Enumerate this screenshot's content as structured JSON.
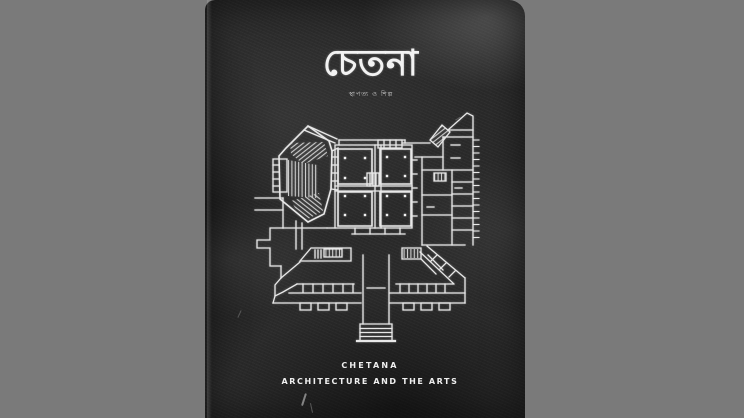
{
  "cover": {
    "masthead": "চেতনা",
    "masthead_subtitle": "স্থাপত্য ও শিল্প",
    "footer_line1": "CHETANA",
    "footer_line2": "ARCHITECTURE AND THE ARTS",
    "illustration_name": "architectural-floor-plan-line-drawing"
  },
  "colors": {
    "letterbox_gray": "#7a7a7a",
    "cover_charcoal": "#2a2a2a",
    "plan_line_white": "#e8e8e8",
    "text_white": "#f2f2f2"
  }
}
